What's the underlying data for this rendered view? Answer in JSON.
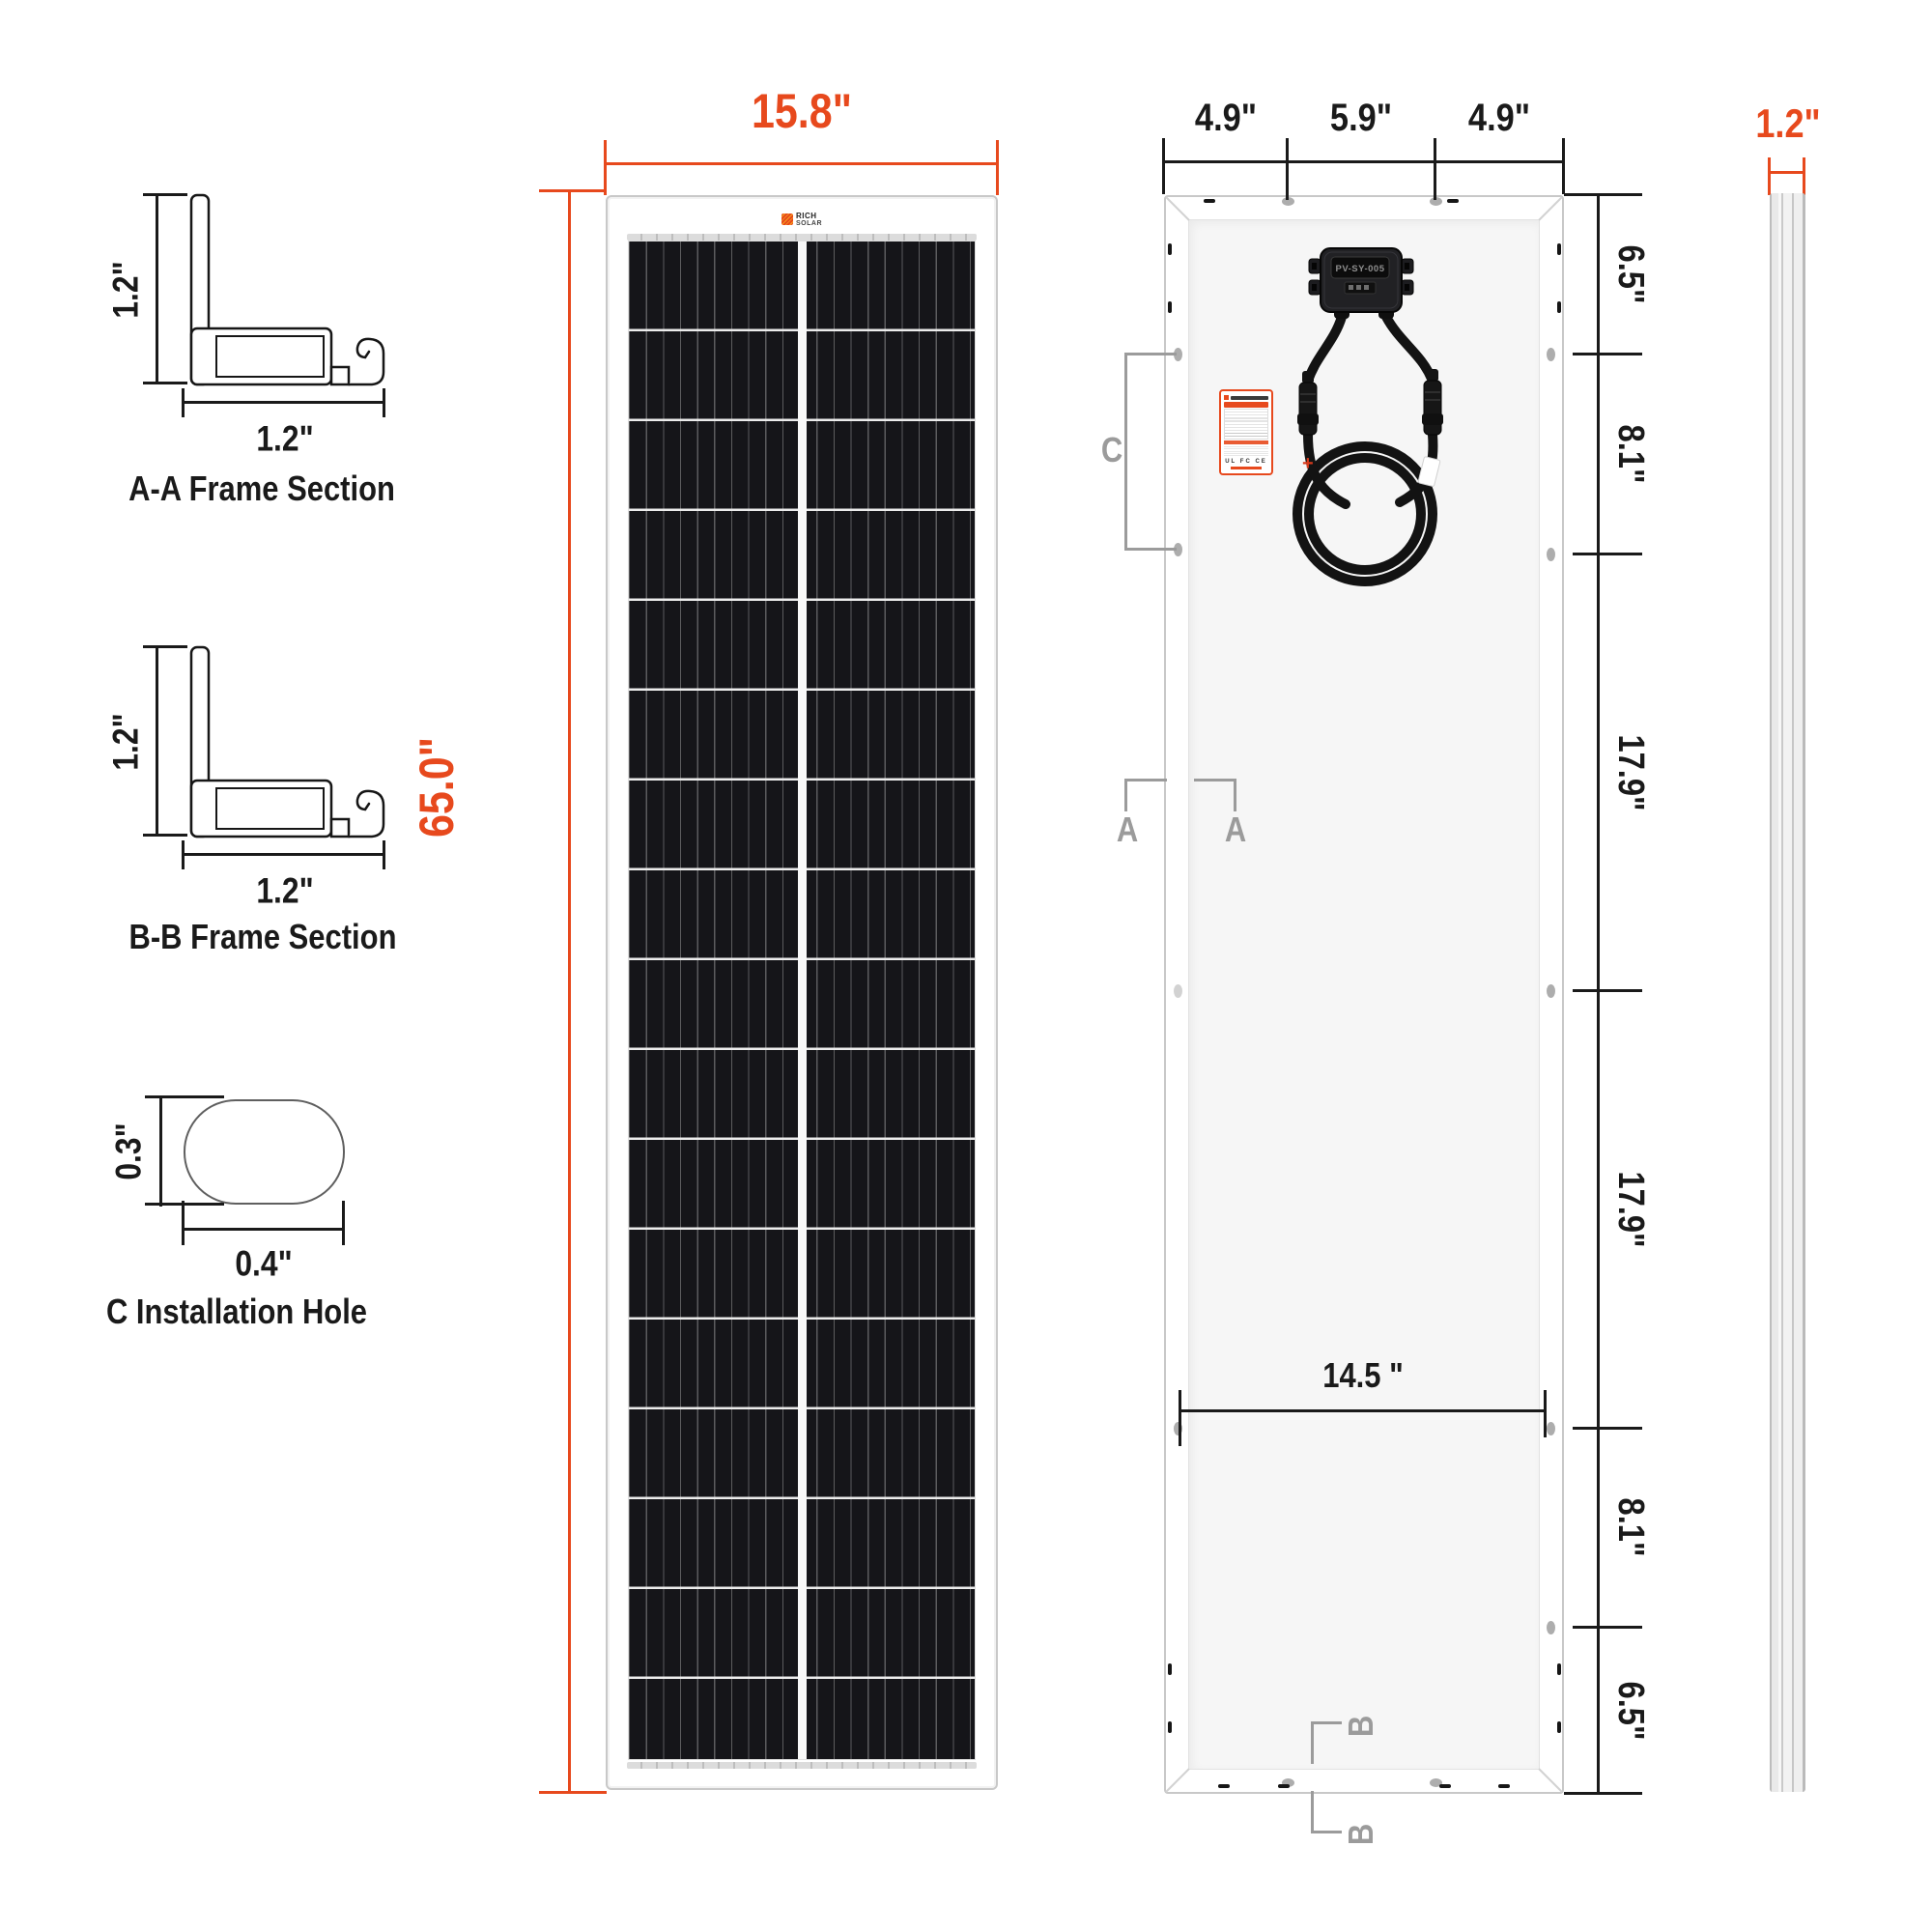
{
  "colors": {
    "accent": "#E7491D",
    "dim": "#1A1A1A",
    "marker": "#9B9B9B",
    "cell_black": "#151519",
    "backsheet": "#F6F6F6",
    "frame_white": "#FFFFFF"
  },
  "sections": {
    "aa": {
      "caption": "A-A Frame Section",
      "height_dim": "1.2\"",
      "width_dim": "1.2\""
    },
    "bb": {
      "caption": "B-B Frame Section",
      "height_dim": "1.2\"",
      "width_dim": "1.2\""
    },
    "hole": {
      "caption": "C Installation Hole",
      "height_dim": "0.3\"",
      "width_dim": "0.4\""
    }
  },
  "front_view": {
    "width_dim": "15.8\"",
    "height_dim": "65.0\"",
    "logo_line1": "RICH",
    "logo_line2": "SOLAR"
  },
  "back_view": {
    "top_dims": [
      "4.9\"",
      "5.9\"",
      "4.9\""
    ],
    "right_dims": [
      "6.5\"",
      "8.1\"",
      "17.9\"",
      "17.9\"",
      "8.1\"",
      "6.5\""
    ],
    "hole_span_dim": "14.5 \"",
    "junction_box_label": "PV-SY-005",
    "marker_a": "A",
    "marker_b": "B",
    "marker_c": "C",
    "cable_polarity": "+",
    "label_certs": "UL FC CE"
  },
  "side_view": {
    "width_dim": "1.2\""
  }
}
